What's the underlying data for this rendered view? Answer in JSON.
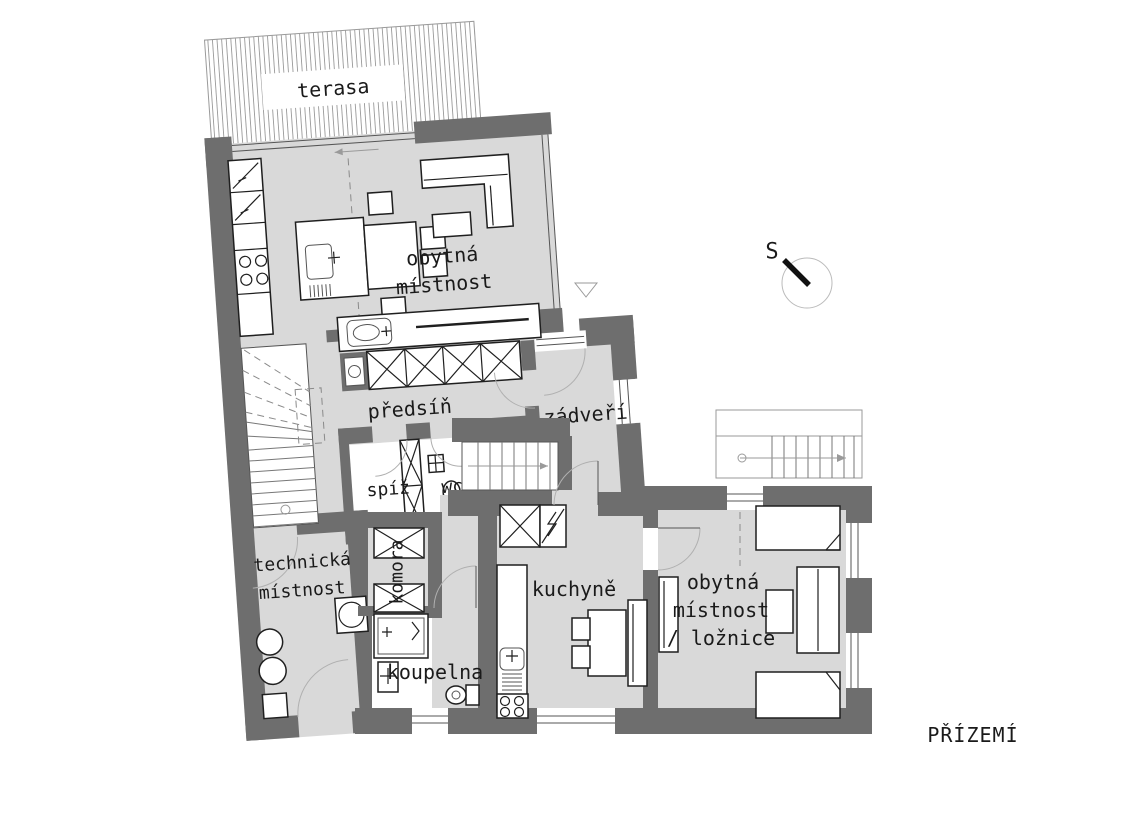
{
  "title": "PŘÍZEMÍ",
  "compass": {
    "label": "S"
  },
  "rooms": {
    "terasa": "terasa",
    "obytna1_l1": "obytná",
    "obytna1_l2": "místnost",
    "predsin": "předsíň",
    "zadveri": "zádveří",
    "spiz": "spíž",
    "wc": "wc",
    "technicka_l1": "technická",
    "technicka_l2": "místnost",
    "komora": "komora",
    "koupelna": "koupelna",
    "kuchyne": "kuchyně",
    "obytna2_l1": "obytná",
    "obytna2_l2": "místnost",
    "obytna2_l3": "/ ložnice"
  },
  "colors": {
    "wall": "#6e6e6e",
    "floor": "#d9d9d9",
    "hatch": "#9a9a9a",
    "line": "#1a1a1a"
  }
}
